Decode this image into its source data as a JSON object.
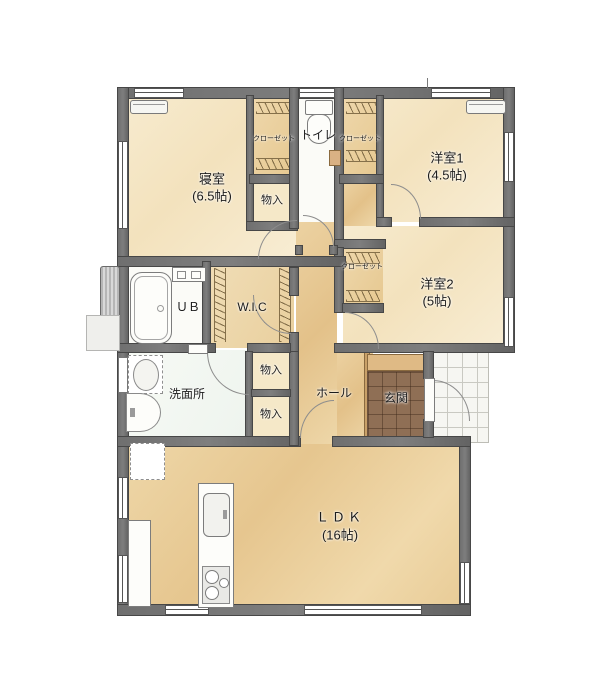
{
  "fp": {
    "title": "1F floor plan",
    "rooms": {
      "bedroom": {
        "name": "寝室",
        "size": "(6.5帖)"
      },
      "western1": {
        "name": "洋室1",
        "size": "(4.5帖)"
      },
      "western2": {
        "name": "洋室2",
        "size": "(5帖)"
      },
      "ldk": {
        "name": "ＬＤＫ",
        "size": "(16帖)"
      },
      "washroom": {
        "name": "洗面所"
      },
      "hall": {
        "name": "ホール"
      },
      "entrance": {
        "name": "玄関"
      },
      "wic": {
        "name": "W.I.C"
      },
      "bath": {
        "name": "ＵＢ"
      },
      "toilet": {
        "name": "トイレ"
      }
    },
    "labels": {
      "closet": "クローゼット",
      "storage": "物入"
    },
    "colors": {
      "wall": "#6f6f6f",
      "room_cream": "#f5e6c6",
      "hall_tan": "#e6c48f",
      "ldk_tan": "#e9cf9d",
      "entrance_tile": "#8f6f55",
      "porch_tile": "#f6f6f2",
      "background": "#ffffff"
    }
  }
}
